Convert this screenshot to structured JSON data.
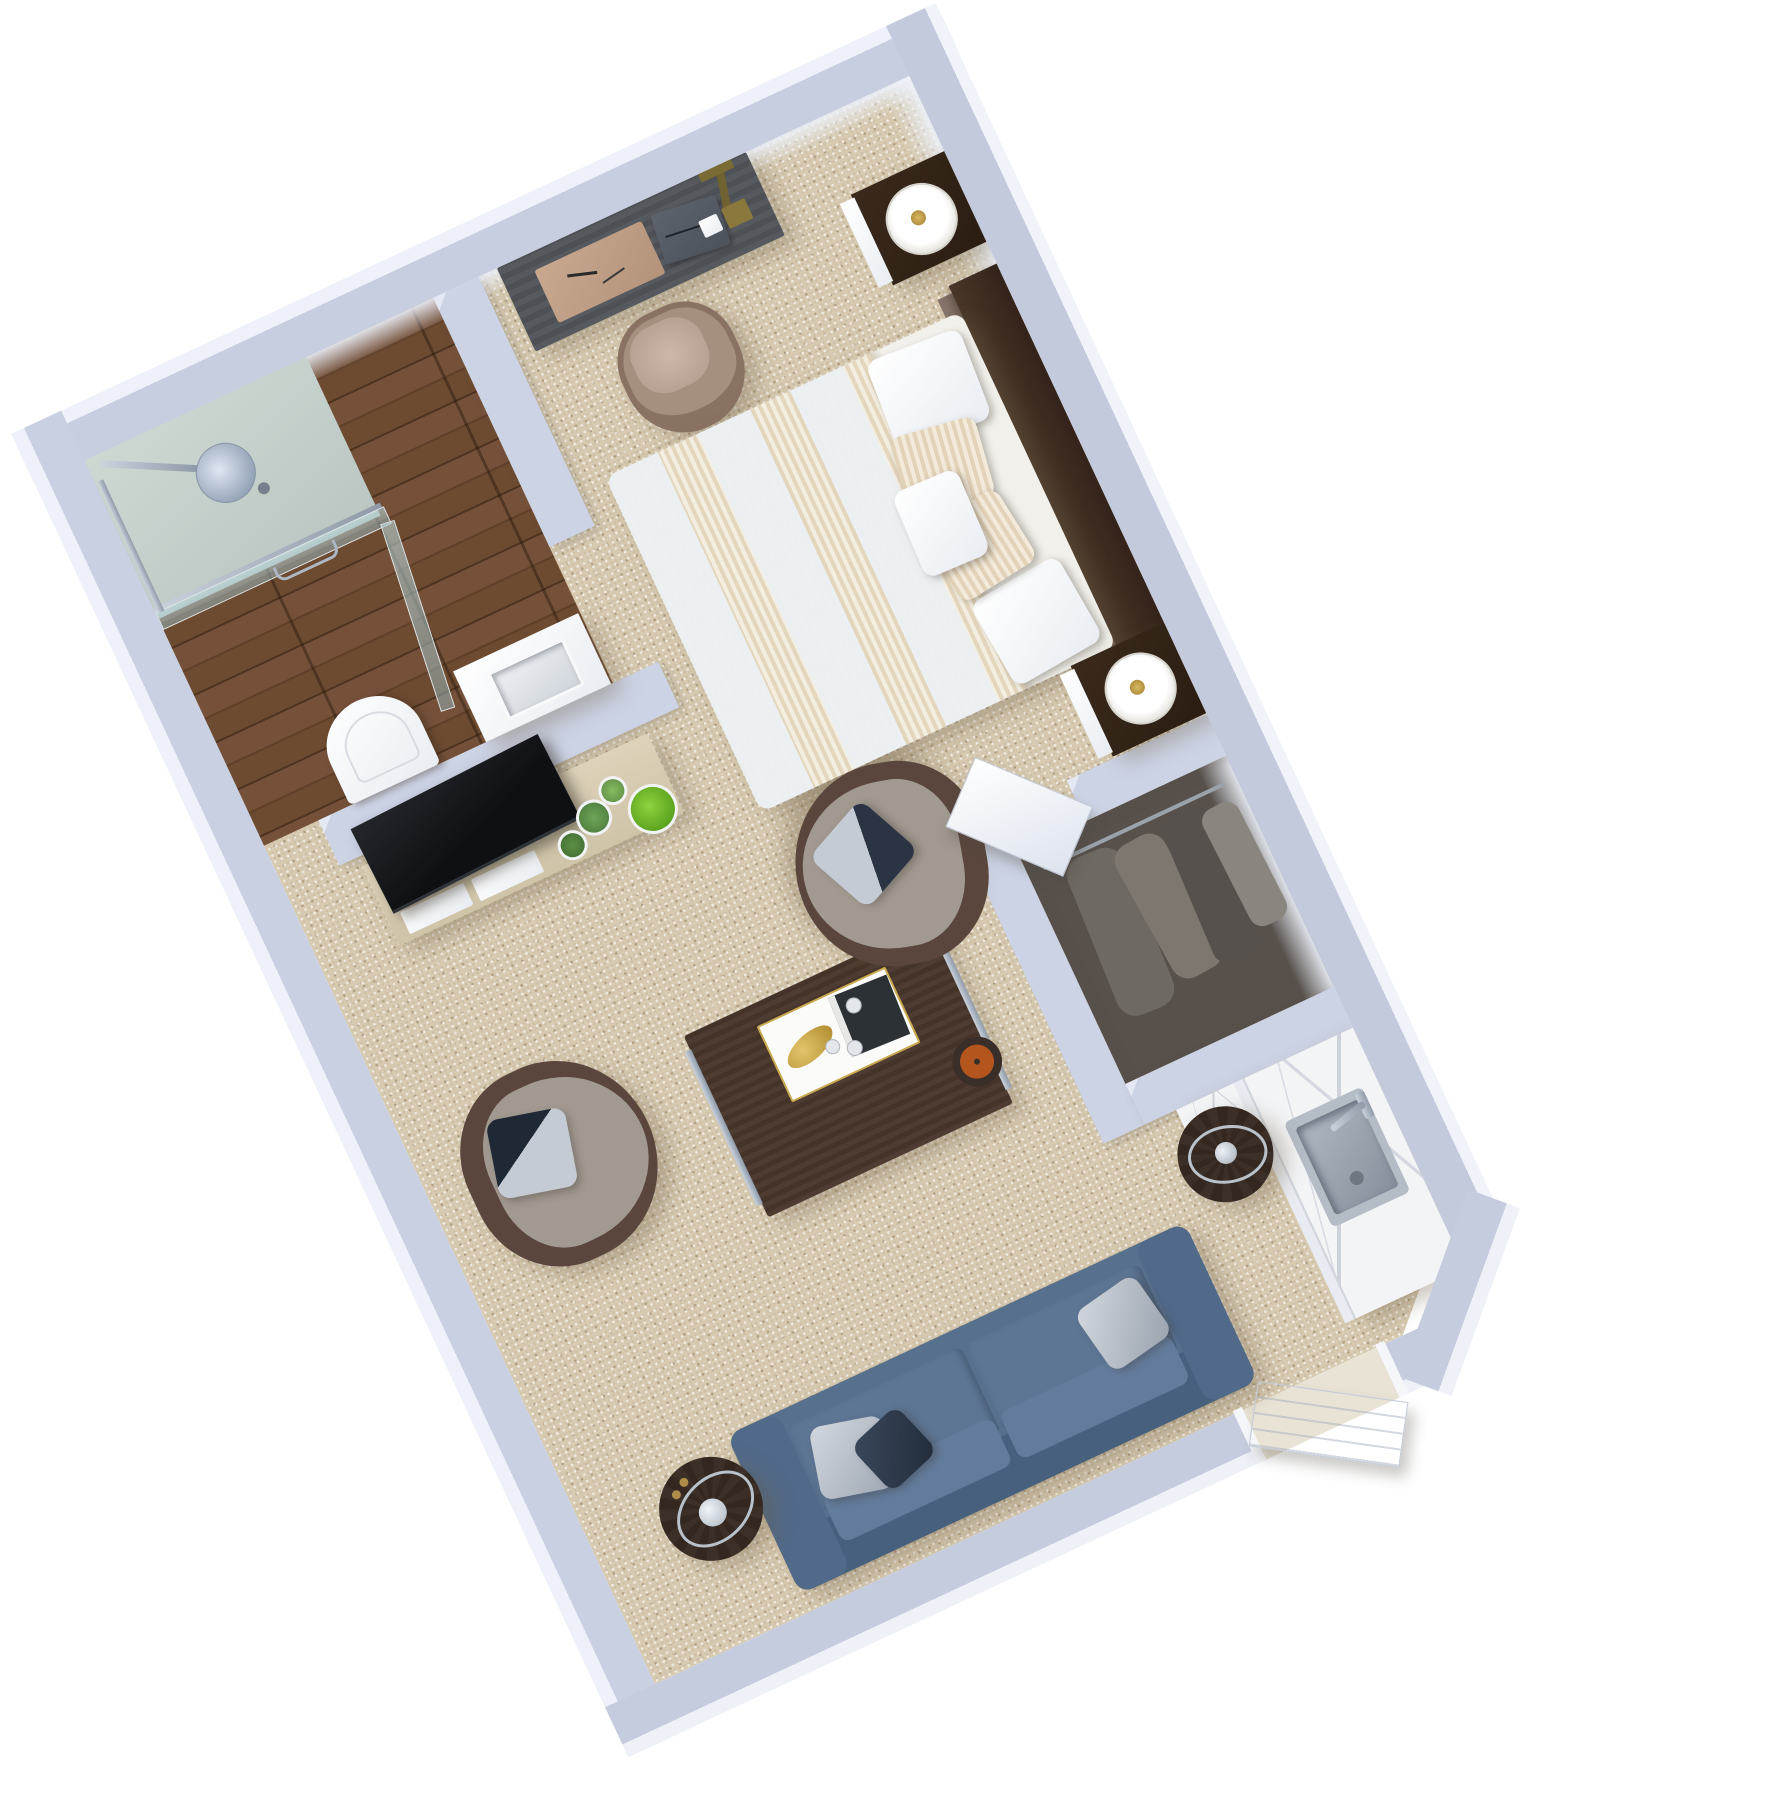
{
  "scene": {
    "title": "3D isometric floor plan of a studio suite",
    "render_style": "top-down axonometric, rotated 25 degrees",
    "background_color": "#ffffff"
  },
  "palette": {
    "wall_face": "#c7cee0",
    "wall_top": "#eef1f9",
    "carpet": "#d7cab0",
    "wood_floor": "#6d4b31",
    "shower_tile": "#c4d0ca",
    "glass": "#bad5d8",
    "sofa_blue": "#57708e",
    "armchair_taupe": "#8b8782",
    "espresso_wood": "#3a2d25",
    "console_beige": "#d6cbb1",
    "marble": "#f3f4f6",
    "brass_gold": "#b58f3c",
    "plant_green": "#6fc32e",
    "tv_black": "#0e1013"
  },
  "items": {
    "bathroom": "Bathroom with walk-in shower",
    "shower": "Glass walk-in shower with rain shower head",
    "toilet": "Toilet",
    "vanity": "Vanity with basin",
    "desk": "Writing desk with pad, notebook and brass lamp",
    "desk_chair": "Tan tub chair",
    "bed": "King bed with striped duvet",
    "headboard": "Dark wood headboard",
    "nightstand_top": "Nightstand with drum lamp",
    "nightstand_bottom": "Nightstand with drum lamp",
    "closet": "Closet with hanging clothes",
    "hall_door": "Open interior door",
    "kitchenette": "Kitchenette with marble counter and sink",
    "sink": "Stainless steel sink with faucet",
    "tv_console": "Media console with potted succulents",
    "tv": "Flat-screen TV",
    "coffee_table": "Coffee table with serving tray",
    "tray": "White tray with gold leaf dish, cups and book",
    "armchair_left": "Barrel armchair with accent pillow",
    "armchair_right": "Barrel armchair with accent pillow",
    "sofa": "Blue three-seat sofa with accent pillows",
    "side_table_left": "Round drum side table with decanter",
    "side_table_right": "Round drum side table",
    "entry_door": "Open entry door"
  },
  "rooms": [
    {
      "name": "bathroom",
      "floor": "dark walnut plank",
      "contents": [
        "walk-in shower",
        "toilet",
        "vanity sink"
      ]
    },
    {
      "name": "sleeping area",
      "floor": "beige carpet",
      "contents": [
        "king bed",
        "2 nightstands",
        "2 drum lamps"
      ]
    },
    {
      "name": "work area",
      "floor": "beige carpet",
      "contents": [
        "desk",
        "tub chair"
      ]
    },
    {
      "name": "living area",
      "floor": "beige carpet",
      "contents": [
        "media console",
        "tv",
        "coffee table",
        "2 armchairs",
        "blue sofa",
        "2 drum side tables"
      ]
    },
    {
      "name": "closet hall",
      "floor": "beige carpet",
      "contents": [
        "hanging clothes",
        "open door"
      ]
    },
    {
      "name": "kitchenette",
      "floor": "beige carpet",
      "contents": [
        "marble counter",
        "stainless sink"
      ]
    },
    {
      "name": "entry",
      "contents": [
        "open entry door"
      ]
    }
  ]
}
